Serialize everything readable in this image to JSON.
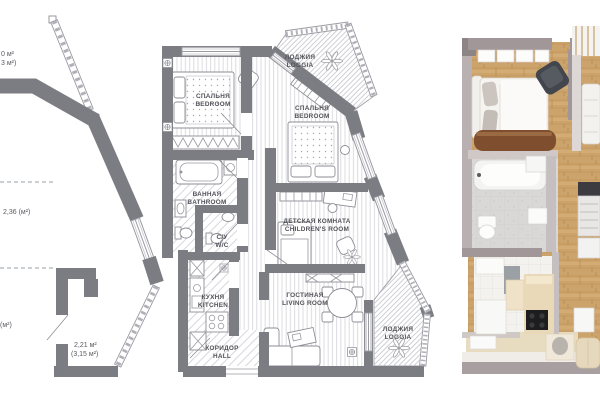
{
  "panels": {
    "left_plan": {
      "labels": {
        "top_area_line1": "0 м²",
        "top_area_line2": "3 м²)",
        "middle_area": "2,36 (м²)",
        "lower_area": "(м²)",
        "bottom_area_line1": "2,21 м²",
        "bottom_area_line2": "(3,15 м²)"
      }
    },
    "middle_plan": {
      "rooms": [
        {
          "id": "bedroom-1",
          "ru": "СПАЛЬНЯ",
          "en": "BEDROOM"
        },
        {
          "id": "loggia-top",
          "ru": "ЛОДЖИЯ",
          "en": "LOGGIA"
        },
        {
          "id": "bedroom-2",
          "ru": "СПАЛЬНЯ",
          "en": "BEDROOM"
        },
        {
          "id": "bathroom",
          "ru": "ВАННАЯ",
          "en": "BATHROOM"
        },
        {
          "id": "wc",
          "ru": "С/У",
          "en": "W/C"
        },
        {
          "id": "children-room",
          "ru": "ДЕТСКАЯ КОМНАТА",
          "en": "CHILDREN'S ROOM"
        },
        {
          "id": "kitchen",
          "ru": "КУХНЯ",
          "en": "KITCHEN"
        },
        {
          "id": "hall",
          "ru": "КОРИДОР",
          "en": "HALL"
        },
        {
          "id": "living-room",
          "ru": "ГОСТИНАЯ",
          "en": "LIVING ROOM"
        },
        {
          "id": "loggia-bottom",
          "ru": "ЛОДЖИЯ",
          "en": "LOGGIA"
        }
      ]
    },
    "right_render": {}
  },
  "colors": {
    "plan_wall": "#7c7c83",
    "plan_line": "#9a9aa2",
    "plan_text": "#53535a",
    "floor_stripe": "#dcdce1",
    "render_wall": "#a29798",
    "render_wood": "#cda36c",
    "render_tile": "#d8d7d5",
    "render_counter": "#ead9b9",
    "render_dark_chair": "#43464c",
    "render_sideboard": "#7e4e2e"
  }
}
